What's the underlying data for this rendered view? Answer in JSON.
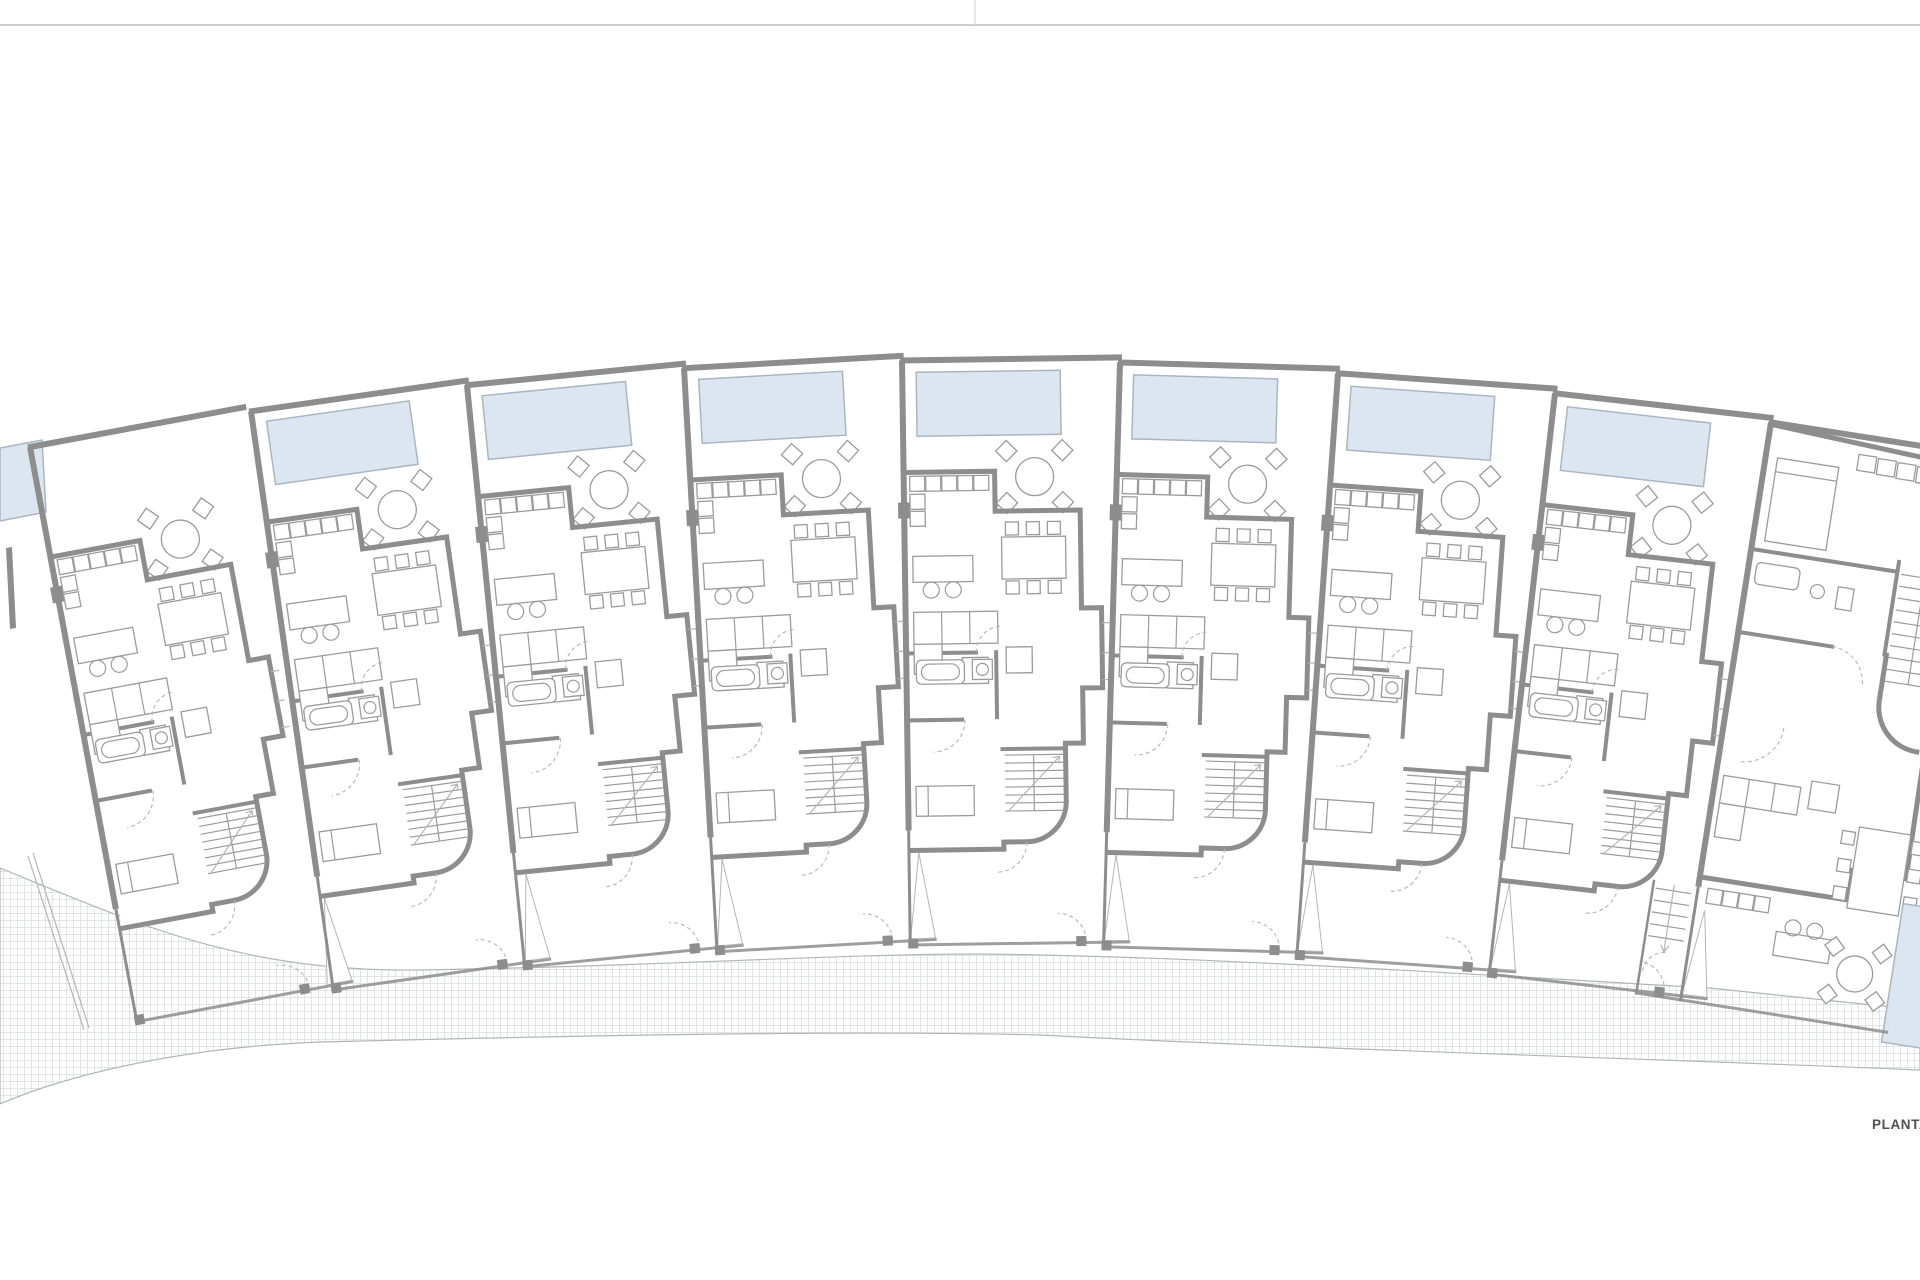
{
  "meta": {
    "drawing_label": "PLANTA"
  },
  "theme": {
    "bg": "#ffffff",
    "wall": "#8d8d8d",
    "line": "#9b9b9b",
    "line-light": "#b5b5b5",
    "pool-fill": "#dce6f0",
    "pool-stroke": "#a9b6c2",
    "hatch": "#dadcde",
    "band-edge": "#b2b5b7",
    "sheet-line": "#cbcdcf",
    "text": "#4f4f4f"
  },
  "plan": {
    "canvas": {
      "width": 1920,
      "height": 1280
    },
    "sheet": {
      "divider_y": 25,
      "tick_x": 975
    },
    "arc": {
      "center_x": 975,
      "center_y": 5500,
      "radius": 5140,
      "unit_pitch": 218
    },
    "label": {
      "text": "PLANTA",
      "x": 1872,
      "y": 1117
    },
    "units": [
      {
        "name": "unit-plan-0-sliver",
        "type": "sliver",
        "x": 0,
        "y": 0,
        "rotate": 0
      },
      {
        "name": "unit-plan-1",
        "type": "typical-nopool",
        "x": 30,
        "y": 447,
        "rotate": -10.53
      },
      {
        "name": "unit-plan-2",
        "type": "typical",
        "x": 251,
        "y": 411.3,
        "rotate": -8.1
      },
      {
        "name": "unit-plan-3",
        "type": "typical",
        "x": 467,
        "y": 385.2,
        "rotate": -5.67
      },
      {
        "name": "unit-plan-4",
        "type": "typical",
        "x": 684,
        "y": 368.2,
        "rotate": -3.24
      },
      {
        "name": "unit-plan-5",
        "type": "typical",
        "x": 902,
        "y": 360.5,
        "rotate": -0.81
      },
      {
        "name": "unit-plan-6",
        "type": "typical",
        "x": 1120,
        "y": 362.5,
        "rotate": 1.62
      },
      {
        "name": "unit-plan-7",
        "type": "typical",
        "x": 1338,
        "y": 373.3,
        "rotate": 4.04
      },
      {
        "name": "unit-plan-8",
        "type": "typical",
        "x": 1555,
        "y": 393.3,
        "rotate": 6.47
      },
      {
        "name": "unit-plan-9-end",
        "type": "end",
        "x": 1771,
        "y": 422.4,
        "rotate": 8.9
      }
    ],
    "type_defs": {
      "typical": "#tpl-typical",
      "typical-nopool": "#tpl-typical-nopool",
      "end": "#tpl-end",
      "sliver": "#tpl-sliver"
    },
    "pavement_band": {
      "d": "M 0,868 C 140,925 240,972 420,970 C 660,966 840,954 978,954 C 1200,956 1480,975 1710,988 L 1920,1010 L 1920,1070 C 1640,1058 1330,1050 1040,1035 C 840,1030 560,1036 320,1042 C 170,1048 60,1078 0,1104 Z",
      "left_boundary": "M 28,856 L 84,1030",
      "left_boundary2": "M 33,853 L 89,1028"
    }
  }
}
